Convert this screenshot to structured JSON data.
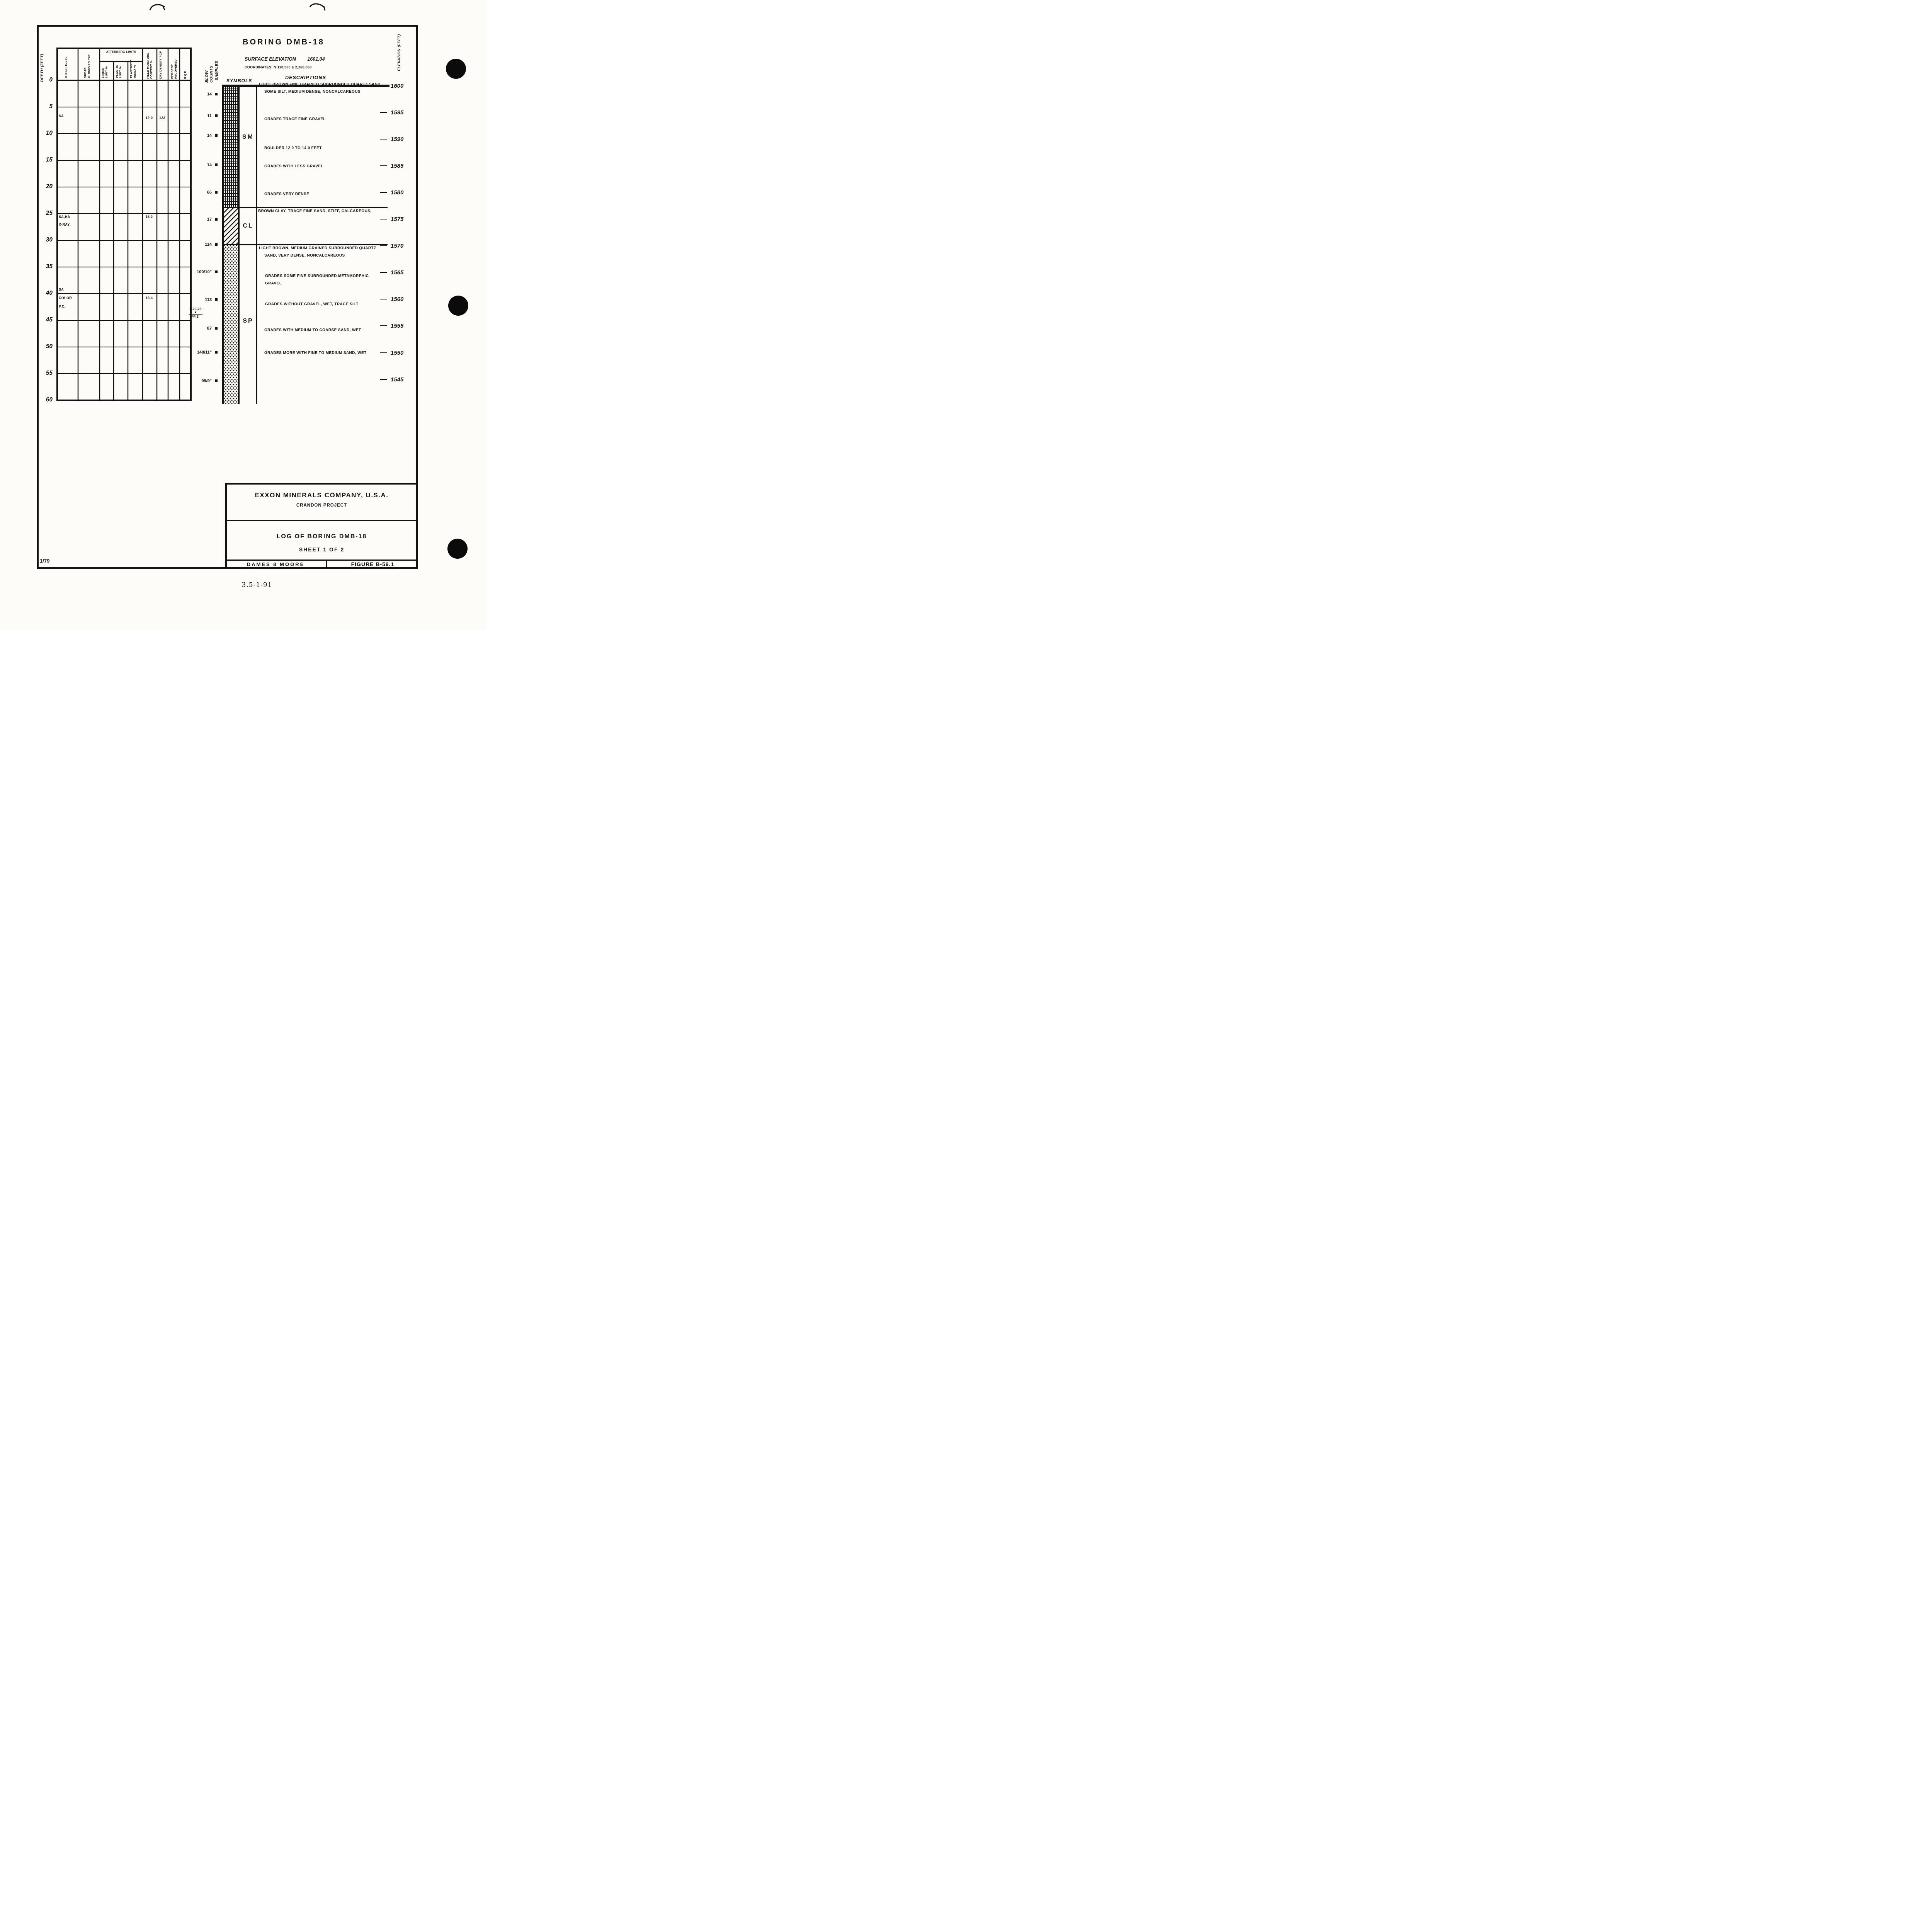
{
  "header": {
    "title": "BORING DMB-18",
    "surface_elevation_label": "SURFACE ELEVATION",
    "surface_elevation_value": "1601.04",
    "coordinates": "COORDINATES: N 110,560  E 2,268,060",
    "symbols_label": "SYMBOLS",
    "descriptions_label": "DESCRIPTIONS"
  },
  "depth_axis": {
    "label": "DEPTH (FEET)",
    "ticks": [
      "0",
      "5",
      "10",
      "15",
      "20",
      "25",
      "30",
      "35",
      "40",
      "45",
      "50",
      "55",
      "60"
    ]
  },
  "elevation_axis": {
    "label": "ELEVATION (FEET)",
    "values": [
      "1600",
      "1595",
      "1590",
      "1585",
      "1580",
      "1575",
      "1570",
      "1565",
      "1560",
      "1555",
      "1550",
      "1545"
    ]
  },
  "left_table": {
    "atterberg_header": "ATTERBERG LIMITS",
    "columns": [
      "OTHER TESTS",
      "SHEAR STRENGTH PSF",
      "LIQUID LIMIT %",
      "PLASTIC LIMIT %",
      "PLASTICITY INDEX %",
      "FIELD MOISTURE CONTENT %",
      "DRY DENSITY PCF",
      "PERCENT RECOVERED",
      "RQD"
    ],
    "entries": {
      "e1": {
        "other_tests": "SA",
        "field_moisture_pct": "12.0",
        "dry_density_pcf": "123"
      },
      "e2": {
        "other_tests_line1": "SA,HA",
        "other_tests_line2": "X-RAY",
        "field_moisture_pct": "16.2"
      },
      "e3": {
        "other_tests_line1": "SA",
        "other_tests_line2": "COLOR",
        "other_tests_line3": "P.C.",
        "field_moisture_pct": "13.4"
      }
    }
  },
  "blow_counts": {
    "label_line1": "BLOW COUNTS",
    "label_line2": "SAMPLES",
    "items": [
      "14",
      "11",
      "14",
      "14",
      "66",
      "17",
      "114",
      "100/10\"",
      "113",
      "87",
      "148/11\"",
      "99/9\""
    ],
    "water_level": {
      "date": "6-26-78",
      "symbol": "▼",
      "depth": "44.2'"
    }
  },
  "strata": {
    "codes": [
      "SM",
      "CL",
      "SP"
    ]
  },
  "descriptions": [
    "LIGHT BROWN FINE GRAINED SUBROUNDED QUARTZ SAND,",
    "SOME SILT, MEDIUM DENSE, NONCALCAREOUS",
    "GRADES TRACE FINE GRAVEL",
    "BOULDER 12.0 TO 14.0 FEET",
    "GRADES WITH LESS GRAVEL",
    "GRADES VERY DENSE",
    "BROWN CLAY, TRACE FINE SAND, STIFF, CALCAREOUS,",
    "LIGHT BROWN, MEDIUM GRAINED SUBROUNDED QUARTZ",
    "SAND, VERY DENSE, NONCALCAREOUS",
    "GRADES SOME FINE SUBROUNDED METAMORPHIC",
    "GRAVEL",
    "GRADES WITHOUT GRAVEL, WET, TRACE SILT",
    "GRADES WITH MEDIUM TO COARSE SAND, WET",
    "GRADES MORE WITH FINE TO MEDIUM SAND, WET"
  ],
  "title_block": {
    "company": "EXXON MINERALS COMPANY, U.S.A.",
    "project": "CRANDON PROJECT",
    "log_title": "LOG OF BORING DMB-18",
    "sheet": "SHEET 1 OF 2",
    "firm": "DAMES 8 MOORE",
    "figure": "FIGURE B-59.1"
  },
  "footer": {
    "left": "1/79",
    "center": "3.5-1-91"
  }
}
